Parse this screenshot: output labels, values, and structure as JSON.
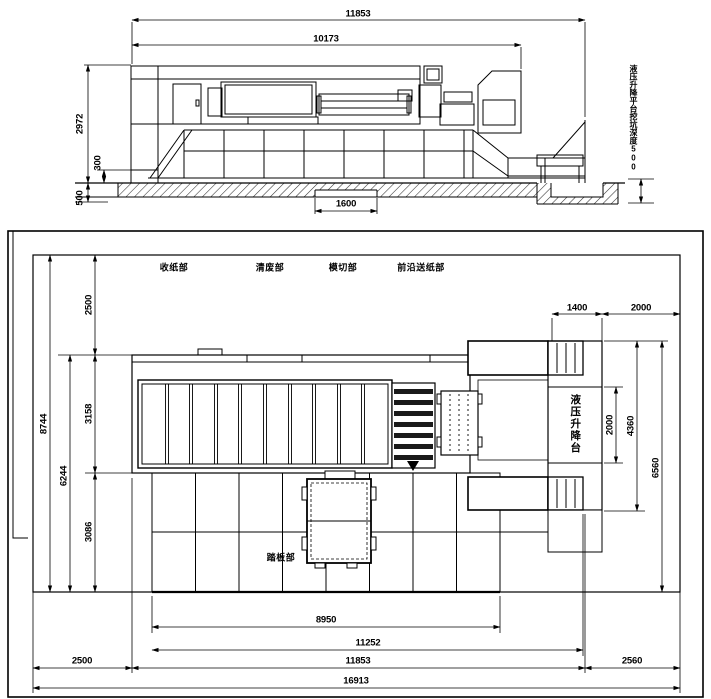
{
  "drawing": {
    "side_view": {
      "note_vertical": "液压升降平台挖坑深度500",
      "dims": {
        "overall_length": "11853",
        "body_length": "10173",
        "machine_height": "2972",
        "foundation_height": "300",
        "pit_depth": "500",
        "trench_width": "1600"
      }
    },
    "plan_view": {
      "section_labels": [
        "收纸部",
        "清废部",
        "模切部",
        "前沿送纸部"
      ],
      "footboard_label": "踏板部",
      "lift_platform_label": "液压升降台",
      "dims": {
        "site_depth": "8744",
        "machine_depth": "6244",
        "top_margin": "2500",
        "conveyor_depth": "3158",
        "footboard_depth": "3086",
        "lift_width": "1400",
        "right_clearance": "2000",
        "lift_length": "2000",
        "platform_length": "4360",
        "right_structure_length": "6560",
        "base_length": "8950",
        "inner_length": "11252",
        "left_margin": "2500",
        "machine_length": "11853",
        "right_margin": "2560",
        "site_length": "16913"
      }
    }
  }
}
